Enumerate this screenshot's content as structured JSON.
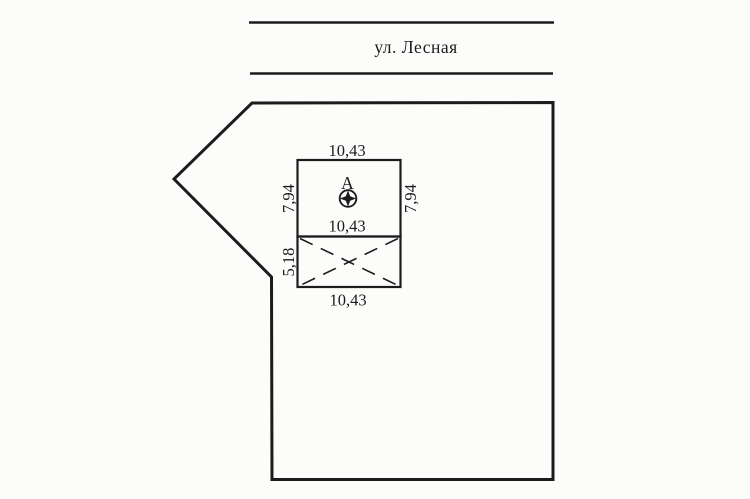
{
  "street": {
    "name": "ул. Лесная"
  },
  "parcel": {
    "building": {
      "label": "А",
      "marker_icon": "survey-point",
      "dimensions": {
        "top_width": "10,43",
        "left_height": "7,94",
        "right_height": "7,94",
        "middle_width": "10,43",
        "extension_height": "5,18",
        "bottom_width": "10,43"
      }
    }
  },
  "colors": {
    "line": "#1c1c1c",
    "background": "#fcfcfb"
  }
}
